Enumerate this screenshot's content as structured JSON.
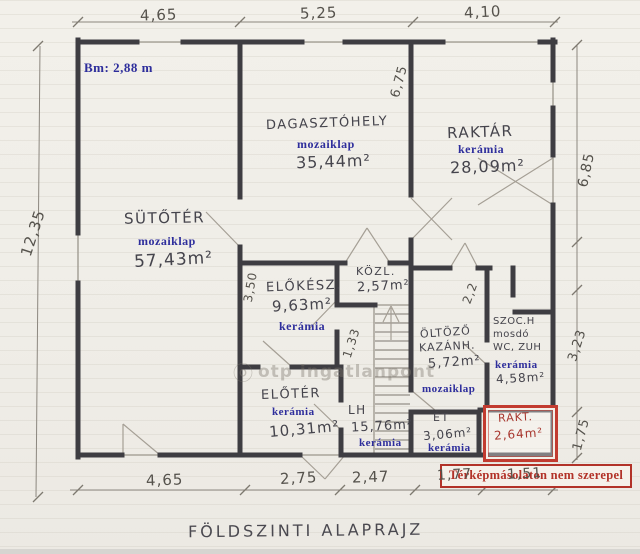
{
  "title": "FÖLDSZINTI ALAPRAJZ",
  "height_note": "Bm: 2,88 m",
  "watermark": "otp ingatlanpont",
  "annotation": "Térképmásolaton nem szerepel",
  "rooms": {
    "sutoter": {
      "name": "SÜTŐTÉR",
      "floor": "mozaiklap",
      "area": "57,43m²"
    },
    "dagasztohely": {
      "name": "DAGASZTÓHELY",
      "floor": "mozaiklap",
      "area": "35,44m²"
    },
    "raktar": {
      "name": "RAKTÁR",
      "floor": "kerámia",
      "area": "28,09m²"
    },
    "elokesz": {
      "name": "ELŐKÉSZ.",
      "area": "9,63m²",
      "floor": "kerámia"
    },
    "kozl": {
      "name": "KÖZL.",
      "area": "2,57m²"
    },
    "oltozo": {
      "name_line1": "ÖLTÖZŐ",
      "name_line2": "KAZÁNH.",
      "area": "5,72m²",
      "floor": "mozaiklap"
    },
    "szoc": {
      "name_line1": "SZOC.H",
      "name_line2": "mosdó",
      "name_line3": "WC, ZUH",
      "floor": "kerámia",
      "area": "4,58m²"
    },
    "eloter": {
      "name": "ELŐTÉR",
      "floor": "kerámia",
      "area": "10,31m²"
    },
    "lh": {
      "name": "LH",
      "area": "15,76m²",
      "floor": "kerámia"
    },
    "et": {
      "name": "ÉT",
      "area": "3,06m²",
      "floor": "kerámia"
    },
    "rakt": {
      "name": "RAKT.",
      "area": "2,64m²"
    }
  },
  "dimensions": {
    "top": {
      "d1": "4,65",
      "d2": "5,25",
      "d3": "4,10"
    },
    "bottom": {
      "d1": "4,65",
      "d2": "2,75",
      "d3": "2,47",
      "d4": "1,77",
      "d5": "1,51"
    },
    "left": {
      "d1": "12,35"
    },
    "right": {
      "d1": "6,85",
      "d2": "3,23",
      "d3": "1,75"
    },
    "interior": {
      "d1": "6,75",
      "d2": "3,50",
      "d3": "1,33",
      "d4": "2,2"
    }
  }
}
